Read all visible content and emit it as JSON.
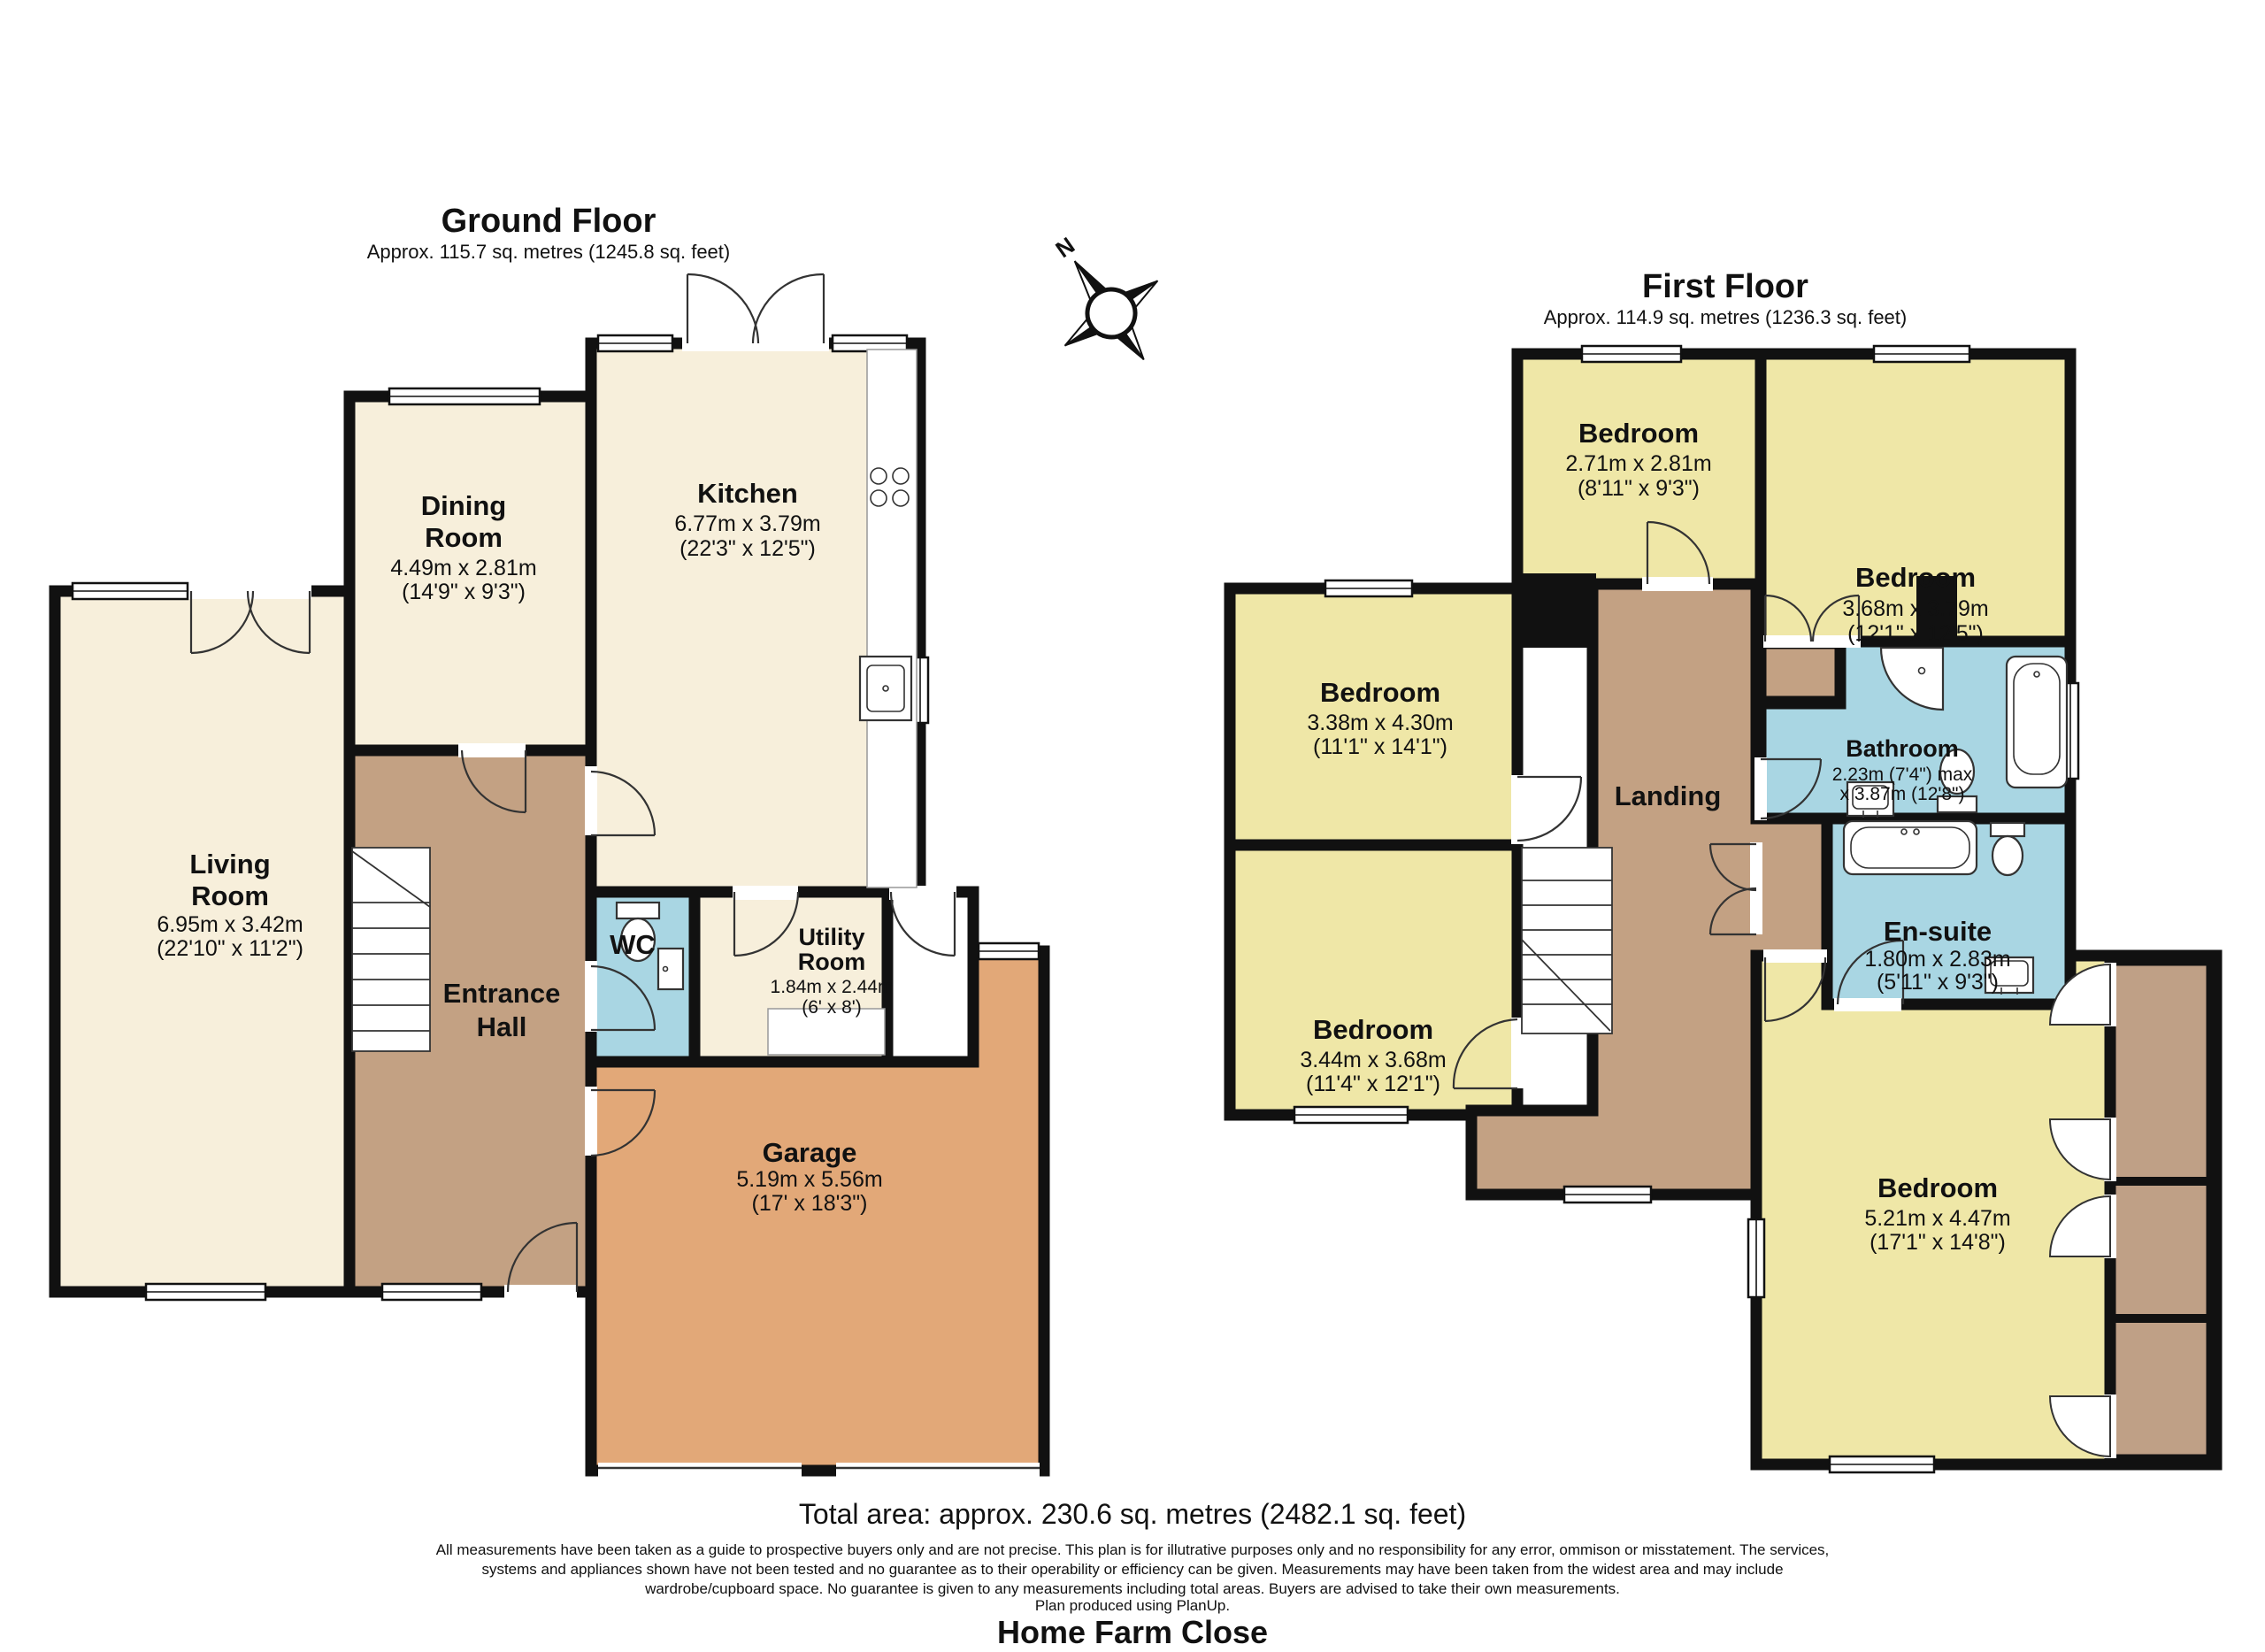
{
  "colors": {
    "wall": "#111111",
    "cream": "#F7EFDB",
    "yellow": "#EFE7A7",
    "blue": "#A9D6E3",
    "brown": "#C3A183",
    "garage": "#E2A878",
    "wardrobe": "#BFA086",
    "white": "#FFFFFF"
  },
  "compass": {
    "label": "N"
  },
  "ground_floor": {
    "title": "Ground Floor",
    "subtitle": "Approx. 115.7 sq. metres (1245.8 sq. feet)",
    "rooms": {
      "dining": {
        "name": "Dining",
        "name2": "Room",
        "dim_m": "4.49m x 2.81m",
        "dim_ft": "(14'9\" x 9'3\")"
      },
      "kitchen": {
        "name": "Kitchen",
        "dim_m": "6.77m x 3.79m",
        "dim_ft": "(22'3\" x 12'5\")"
      },
      "living": {
        "name": "Living",
        "name2": "Room",
        "dim_m": "6.95m x 3.42m",
        "dim_ft": "(22'10\" x 11'2\")"
      },
      "hall": {
        "name": "Entrance",
        "name2": "Hall"
      },
      "wc": {
        "name": "WC"
      },
      "utility": {
        "name": "Utility",
        "name2": "Room",
        "dim_m": "1.84m x 2.44m",
        "dim_ft": "(6' x 8')"
      },
      "garage": {
        "name": "Garage",
        "dim_m": "5.19m x 5.56m",
        "dim_ft": "(17' x 18'3\")"
      }
    }
  },
  "first_floor": {
    "title": "First Floor",
    "subtitle": "Approx. 114.9 sq. metres (1236.3 sq. feet)",
    "rooms": {
      "bedroom1": {
        "name": "Bedroom",
        "dim_m": "2.71m x 2.81m",
        "dim_ft": "(8'11\" x 9'3\")"
      },
      "bedroom2": {
        "name": "Bedroom",
        "dim_m": "3.68m x 3.79m",
        "dim_ft": "(12'1\" x 12'5\")"
      },
      "bedroom3": {
        "name": "Bedroom",
        "dim_m": "3.38m x 4.30m",
        "dim_ft": "(11'1\" x 14'1\")"
      },
      "landing": {
        "name": "Landing"
      },
      "bathroom": {
        "name": "Bathroom",
        "dim_m": "2.23m (7'4\") max",
        "dim_ft": "x 3.87m (12'8\")"
      },
      "ensuite": {
        "name": "En-suite",
        "dim_m": "1.80m x 2.83m",
        "dim_ft": "(5'11\" x 9'3\")"
      },
      "bedroom4": {
        "name": "Bedroom",
        "dim_m": "3.44m x 3.68m",
        "dim_ft": "(11'4\" x 12'1\")"
      },
      "bedroom5": {
        "name": "Bedroom",
        "dim_m": "5.21m x 4.47m",
        "dim_ft": "(17'1\" x 14'8\")"
      }
    }
  },
  "footer": {
    "total_area": "Total area: approx. 230.6 sq. metres (2482.1 sq. feet)",
    "disclaimer_lines": [
      "All measurements have been taken as a guide to prospective buyers only and are not precise. This plan is for illutrative purposes only and no responsibility for any error, ommison or misstatement. The services,",
      "systems and appliances shown have not been tested and no guarantee as to their operability or efficiency can be given. Measurements may have been taken from the widest area and may include",
      "wardrobe/cupboard space. No guarantee is given to any measurements including total areas. Buyers are advised to take their own measurements.",
      "Plan produced using PlanUp."
    ],
    "address": "Home Farm Close"
  }
}
